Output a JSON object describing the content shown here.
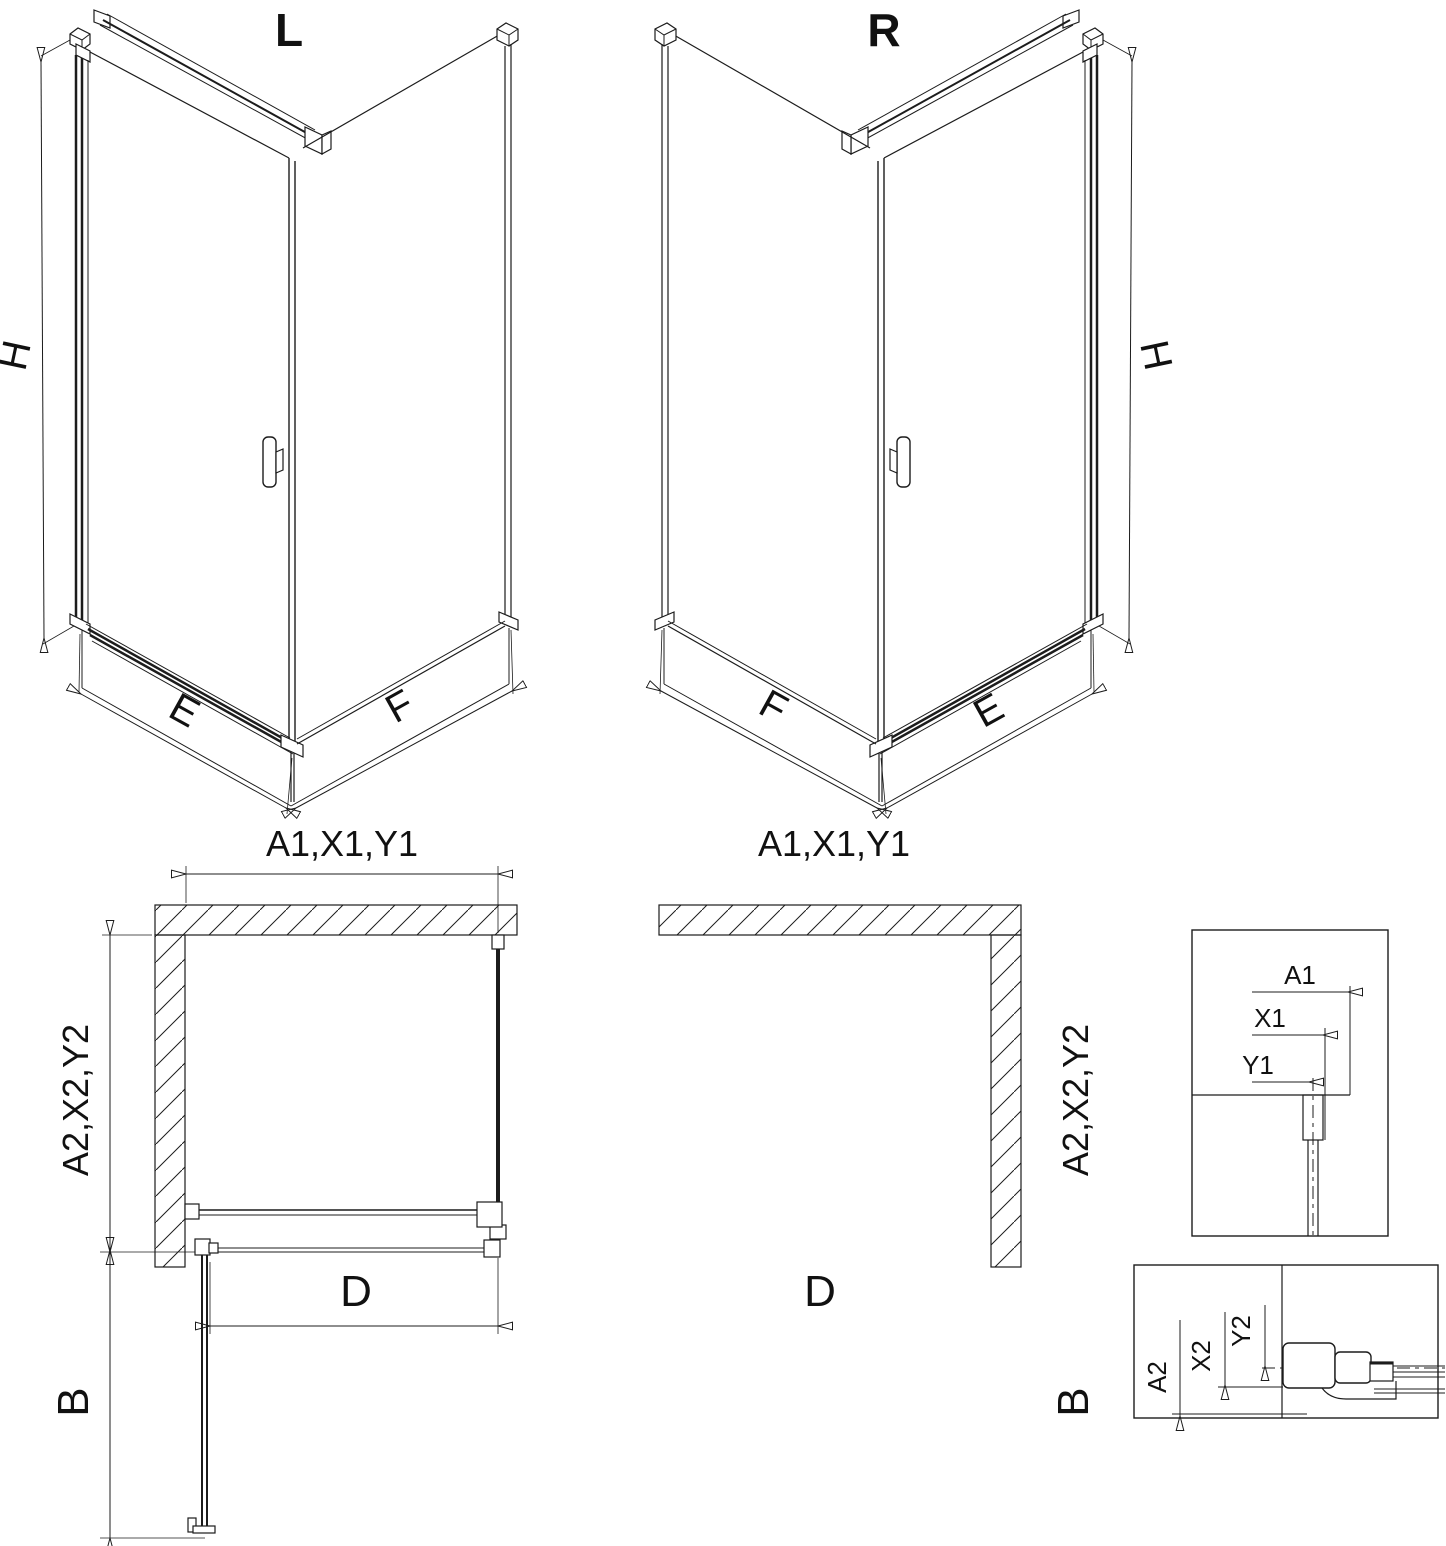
{
  "drawing": {
    "background": "#ffffff",
    "line_color": "#1c1c1c",
    "views": {
      "iso_left": {
        "title": "L",
        "dim_height": "H",
        "dim_door_width": "E",
        "dim_side_width": "F"
      },
      "iso_right": {
        "title": "R",
        "dim_height": "H",
        "dim_door_width": "E",
        "dim_side_width": "F"
      },
      "plan_left": {
        "dim_top": "A1,X1,Y1",
        "dim_side": "A2,X2,Y2",
        "dim_clear_width": "D",
        "dim_door_projection": "B"
      },
      "plan_right": {
        "dim_top": "A1,X1,Y1",
        "dim_side": "A2,X2,Y2",
        "dim_clear_width": "D",
        "dim_door_projection": "B"
      },
      "detail_wall_profile": {
        "dim_1": "A1",
        "dim_2": "X1",
        "dim_3": "Y1"
      },
      "detail_hinge_profile": {
        "dim_1": "A2",
        "dim_2": "X2",
        "dim_3": "Y2"
      }
    }
  }
}
